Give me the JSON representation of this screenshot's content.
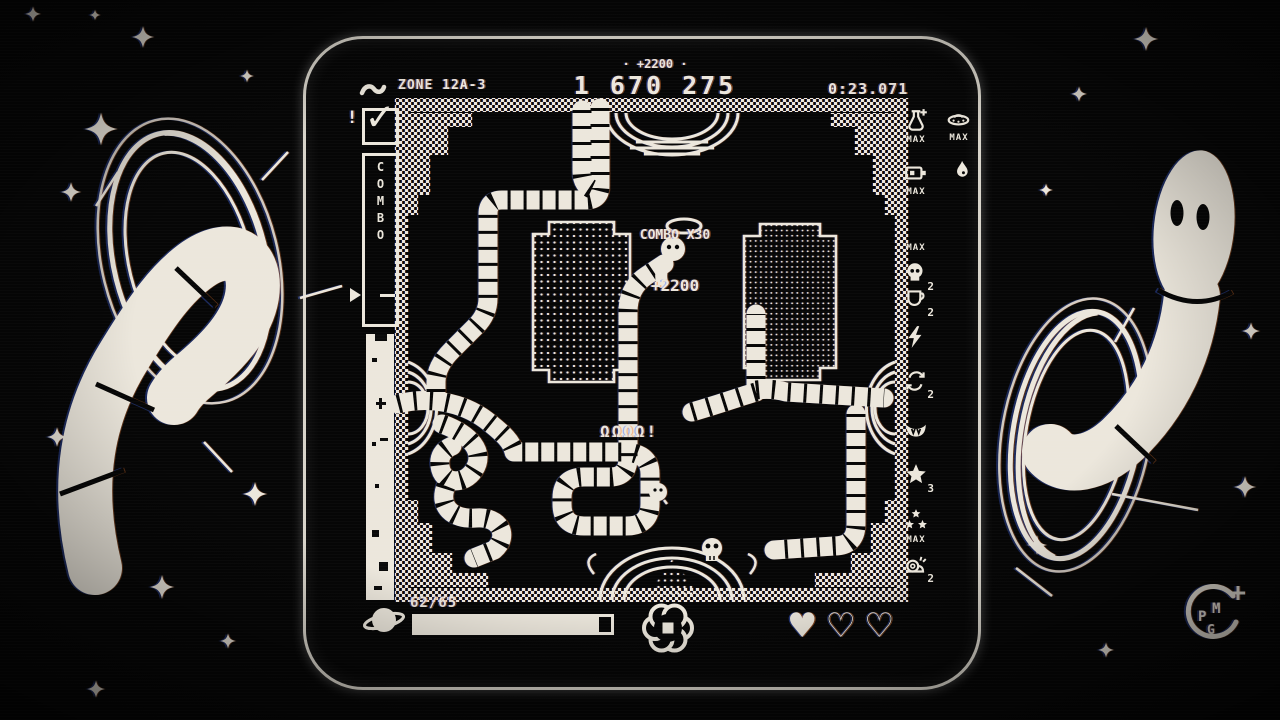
{
  "hud": {
    "zone": "ZONE 12A-3",
    "score_delta": "· +2200 ·",
    "score": "1 670 275",
    "timer": "0:23.071"
  },
  "combo": {
    "alert": "!",
    "check": "✓",
    "label": "COMBO"
  },
  "floating": {
    "combo_text": "COMBO X30",
    "combo_points": "+2200",
    "chatter": "ΩΩΩΩ!"
  },
  "powerups": {
    "col1": [
      {
        "icon": "flask-plus-icon",
        "label": "MAX"
      },
      {
        "icon": "battery-icon",
        "label": "MAX"
      },
      {
        "icon": "crescent-icon",
        "label": "MAX"
      },
      {
        "icon": "skull-icon",
        "label": "2"
      },
      {
        "icon": "cup-icon",
        "label": "2"
      },
      {
        "icon": "bolt-icon",
        "label": ""
      },
      {
        "icon": "refresh-icon",
        "label": "2"
      },
      {
        "icon": "fangs-icon",
        "label": ""
      },
      {
        "icon": "star-icon",
        "label": "3"
      },
      {
        "icon": "triple-star-icon",
        "label": "MAX"
      },
      {
        "icon": "snail-icon",
        "label": "2"
      }
    ],
    "col2": [
      {
        "icon": "ufo-icon",
        "label": "MAX"
      },
      {
        "icon": "droplet-icon",
        "label": ""
      }
    ]
  },
  "status_bar": {
    "count": "62/65",
    "fill_style": "width:94%",
    "hearts": [
      "♥",
      "♡",
      "♡"
    ]
  },
  "logo": {
    "p": "P",
    "m": "M",
    "g": "G"
  },
  "colors": {
    "ink": "#ece7dc",
    "bg": "#060606"
  }
}
